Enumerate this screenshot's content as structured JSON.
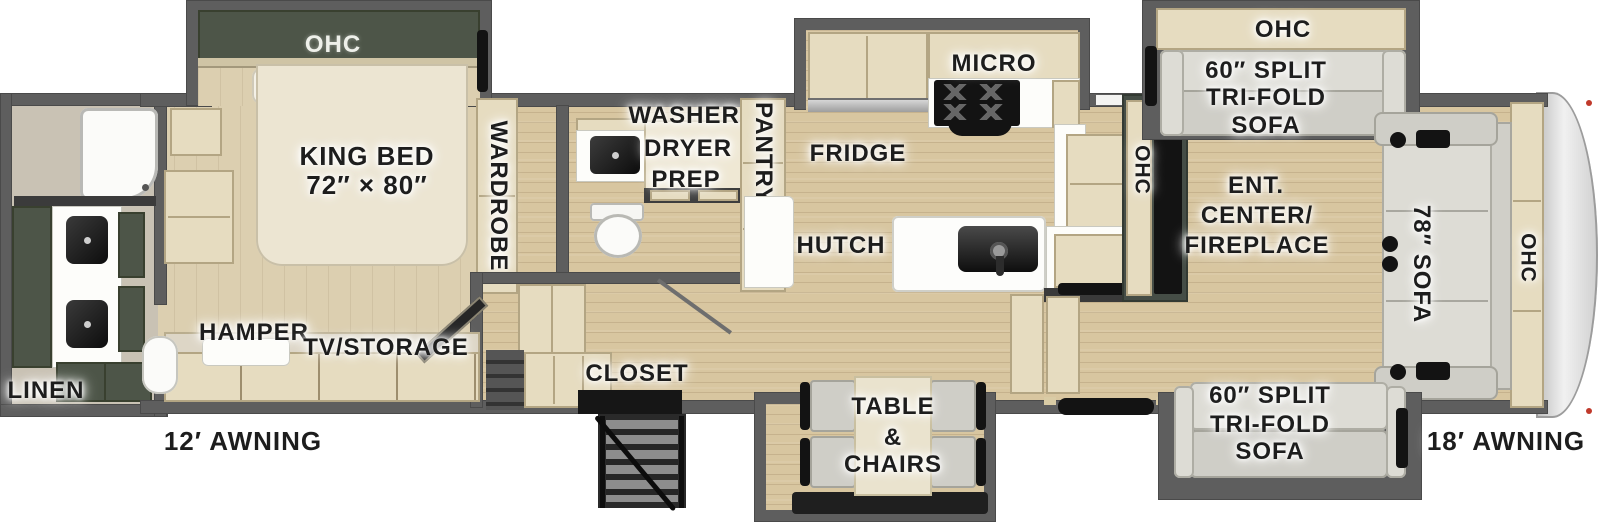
{
  "title": "Fifth-wheel RV floor plan",
  "labels": {
    "bedroom": {
      "ohc": "OHC",
      "king_bed_line1": "KING BED",
      "king_bed_line2": "72″ × 80″",
      "wardrobe": "WARDROBE"
    },
    "rear_bath": {
      "linen": "LINEN"
    },
    "mid_bath": {
      "washer_line1": "WASHER/",
      "washer_line2": "DRYER",
      "washer_line3": "PREP"
    },
    "storage": {
      "hamper": "HAMPER",
      "tv_storage": "TV/STORAGE",
      "closet": "CLOSET"
    },
    "kitchen": {
      "pantry": "PANTRY",
      "fridge": "FRIDGE",
      "micro": "MICRO",
      "hutch": "HUTCH",
      "ohc": "OHC"
    },
    "living": {
      "ent_line1": "ENT.",
      "ent_line2": "CENTER/",
      "ent_line3": "FIREPLACE",
      "ohc_top_sofa": "OHC",
      "sofa_top_line1": "60″ SPLIT",
      "sofa_top_line2": "TRI-FOLD",
      "sofa_top_line3": "SOFA",
      "sofa_bottom_line1": "60″ SPLIT",
      "sofa_bottom_line2": "TRI-FOLD",
      "sofa_bottom_line3": "SOFA",
      "front_sofa": "78″ SOFA",
      "ohc_front": "OHC"
    },
    "dinette": {
      "line1": "TABLE",
      "line2": "&",
      "line3": "CHAIRS"
    },
    "exterior": {
      "awning_left": "12′ AWNING",
      "awning_right": "18′ AWNING"
    }
  },
  "colors": {
    "wall": "#5e5e5e",
    "floor": "#d8c6a0",
    "cabinet": "#e6dcc0",
    "green": "#4d5548",
    "labelInk": "#1d1d1d",
    "fixtureBlack": "#131313",
    "sofaGray": "#dddcd5",
    "capGray": "#d9d9d9"
  }
}
